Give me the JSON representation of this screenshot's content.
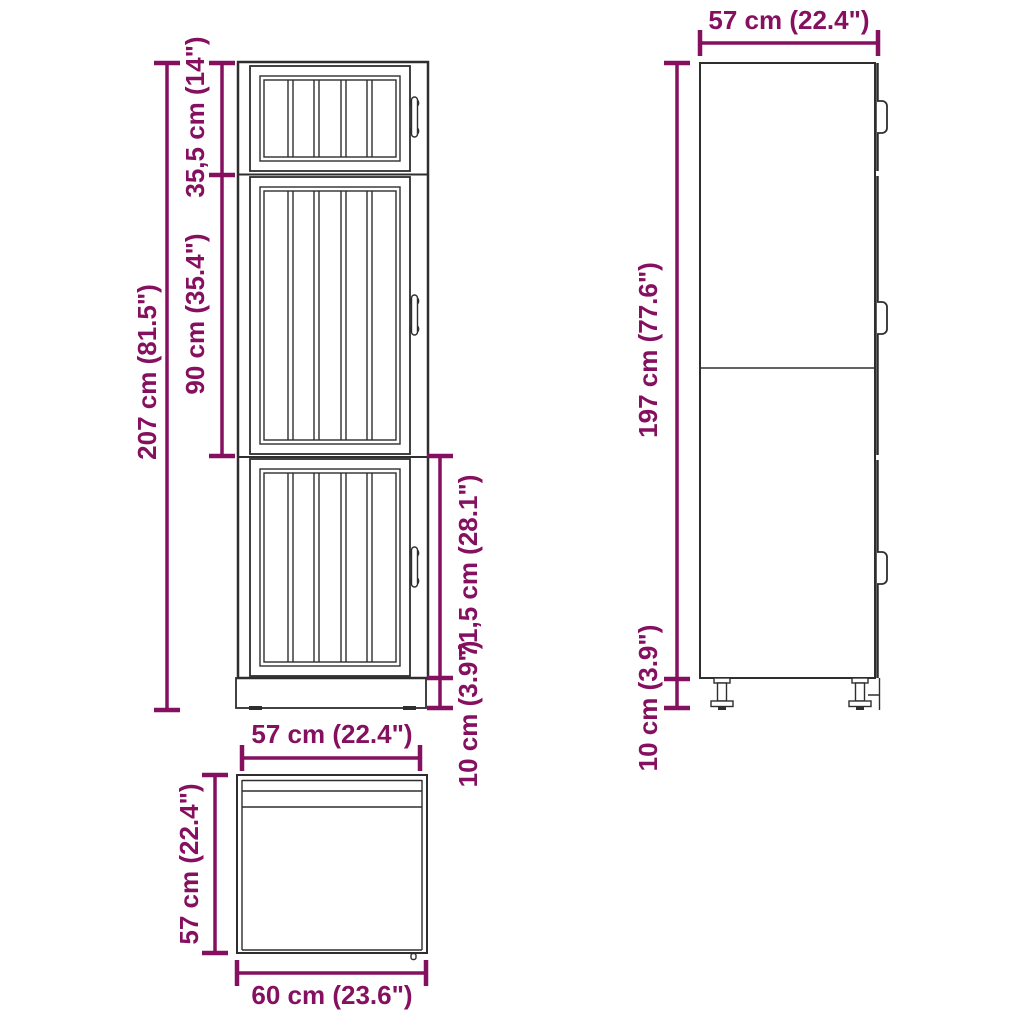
{
  "colors": {
    "dimension": "#861060",
    "drawing": "#2e2e2e",
    "background": "#ffffff"
  },
  "labels": {
    "front_total_height": "207 cm (81.5\")",
    "front_top_section": "35,5 cm (14\")",
    "front_middle_section": "90 cm (35.4\")",
    "front_bottom_section": "71,5 cm (28.1\")",
    "front_plinth_height": "10 cm (3.9\")",
    "side_depth": "57 cm (22.4\")",
    "side_body_height": "197 cm (77.6\")",
    "side_plinth_height": "10 cm (3.9\")",
    "top_depth": "57 cm (22.4\")",
    "top_side_depth": "57 cm (22.4\")",
    "top_width": "60 cm (23.6\")"
  }
}
